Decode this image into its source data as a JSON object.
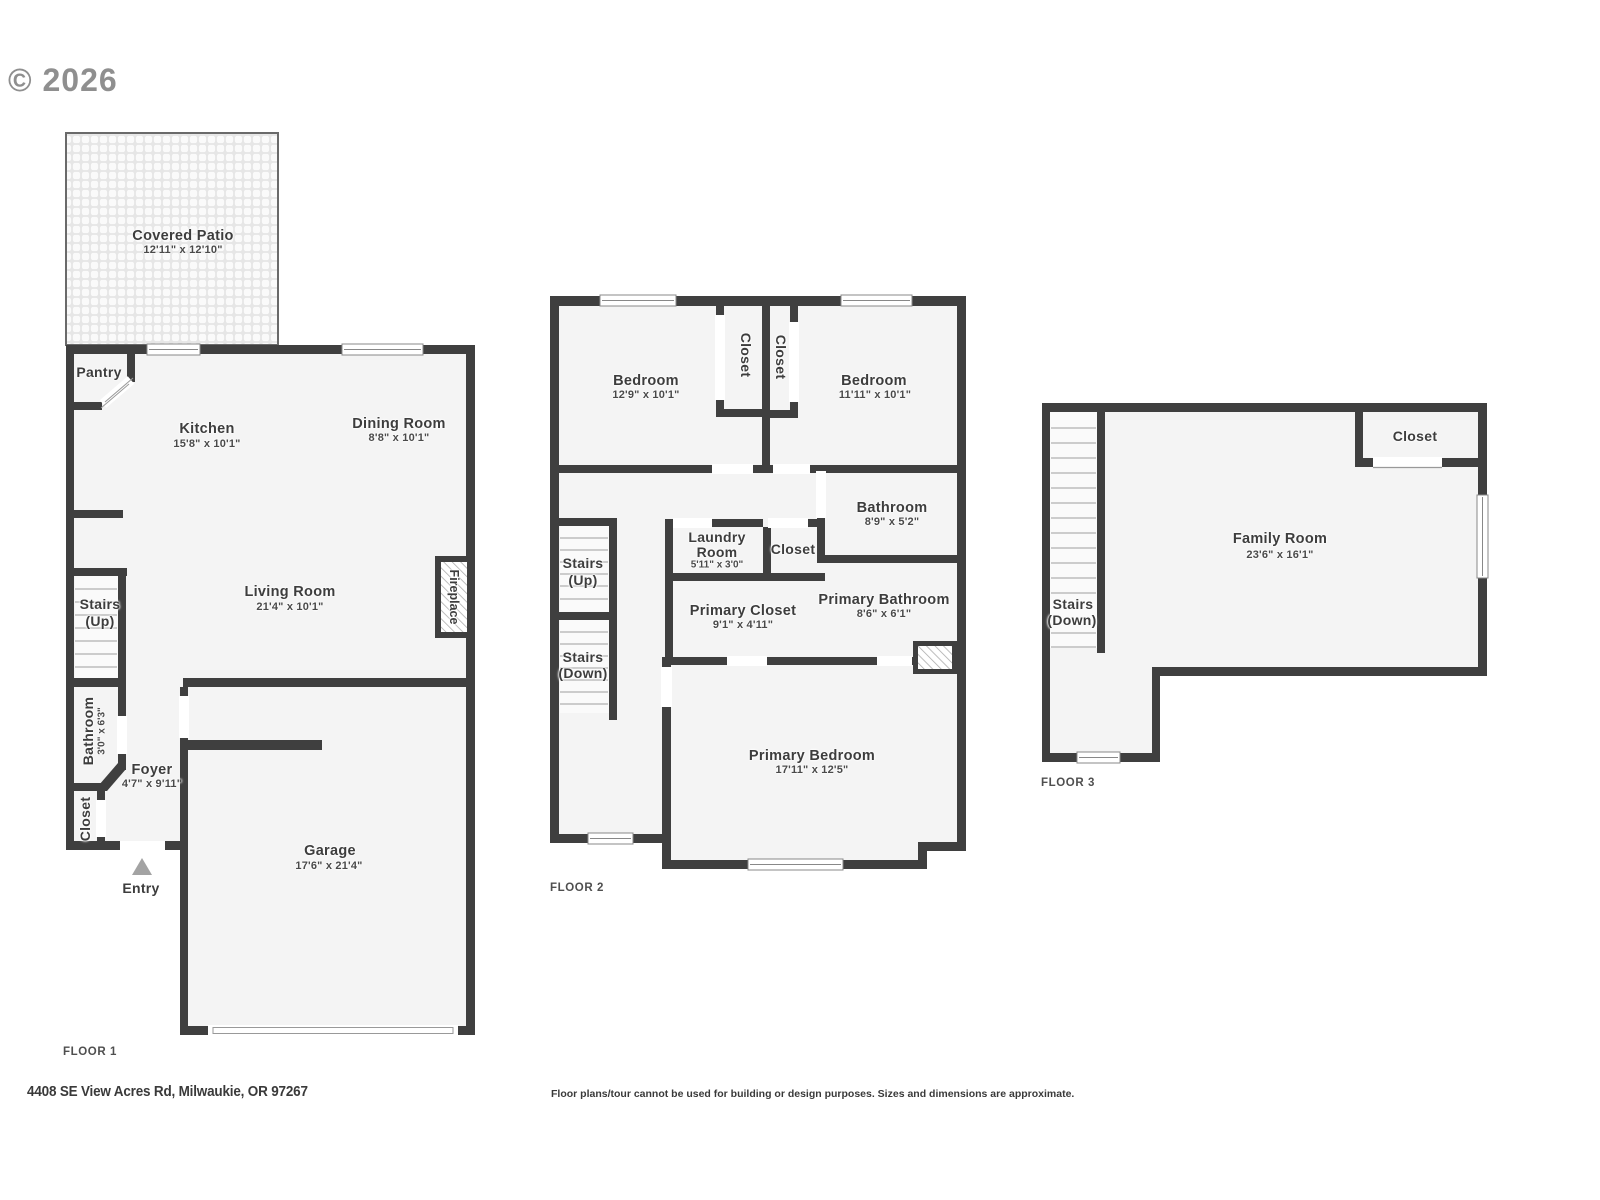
{
  "copyright": "© 2026",
  "floor1": {
    "title": "FLOOR 1",
    "covered_patio": {
      "name": "Covered Patio",
      "dims": "12'11\" x 12'10\""
    },
    "pantry": {
      "name": "Pantry"
    },
    "kitchen": {
      "name": "Kitchen",
      "dims": "15'8\" x 10'1\""
    },
    "dining_room": {
      "name": "Dining Room",
      "dims": "8'8\" x 10'1\""
    },
    "living_room": {
      "name": "Living Room",
      "dims": "21'4\" x 10'1\""
    },
    "stairs_up": {
      "line1": "Stairs",
      "line2": "(Up)"
    },
    "bathroom": {
      "name": "Bathroom",
      "dims": "3'0\" x 6'3\""
    },
    "closet": {
      "name": "Closet"
    },
    "foyer": {
      "name": "Foyer",
      "dims": "4'7\" x 9'11\""
    },
    "entry": {
      "name": "Entry"
    },
    "garage": {
      "name": "Garage",
      "dims": "17'6\" x 21'4\""
    },
    "fireplace": {
      "name": "Fireplace"
    }
  },
  "floor2": {
    "title": "FLOOR 2",
    "bedroom_left": {
      "name": "Bedroom",
      "dims": "12'9\" x 10'1\""
    },
    "bedroom_right": {
      "name": "Bedroom",
      "dims": "11'11\" x 10'1\""
    },
    "closet_left": {
      "name": "Closet"
    },
    "closet_right": {
      "name": "Closet"
    },
    "closet_hall": {
      "name": "Closet"
    },
    "bathroom": {
      "name": "Bathroom",
      "dims": "8'9\" x 5'2\""
    },
    "laundry": {
      "line1": "Laundry",
      "line2": "Room",
      "dims": "5'11\" x 3'0\""
    },
    "stairs_up": {
      "line1": "Stairs",
      "line2": "(Up)"
    },
    "stairs_down": {
      "line1": "Stairs",
      "line2": "(Down)"
    },
    "primary_closet": {
      "name": "Primary Closet",
      "dims": "9'1\" x 4'11\""
    },
    "primary_bathroom": {
      "name": "Primary Bathroom",
      "dims": "8'6\" x 6'1\""
    },
    "primary_bedroom": {
      "name": "Primary Bedroom",
      "dims": "17'11\" x 12'5\""
    }
  },
  "floor3": {
    "title": "FLOOR 3",
    "closet": {
      "name": "Closet"
    },
    "family_room": {
      "name": "Family Room",
      "dims": "23'6\" x 16'1\""
    },
    "stairs_down": {
      "line1": "Stairs",
      "line2": "(Down)"
    }
  },
  "footer": {
    "address": "4408 SE View Acres Rd, Milwaukie, OR 97267",
    "disclaimer": "Floor plans/tour cannot be used for building or design purposes. Sizes and dimensions are approximate."
  }
}
